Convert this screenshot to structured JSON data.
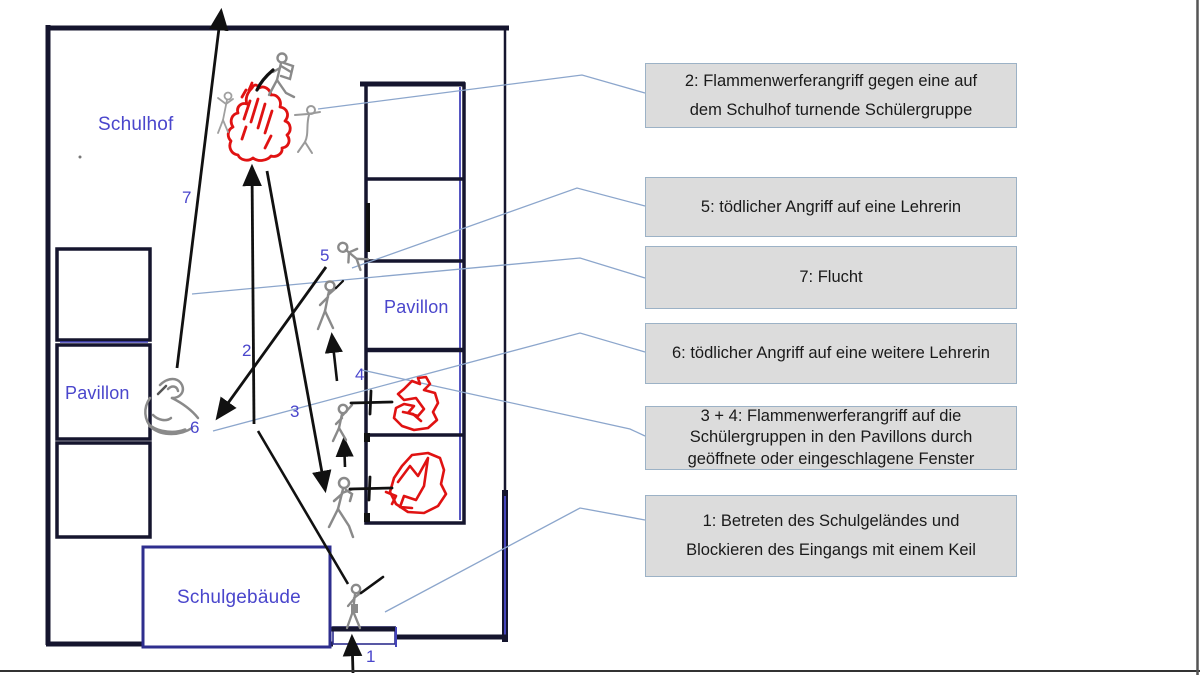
{
  "plan": {
    "area_labels": [
      {
        "id": "schulhof",
        "label": "Schulhof"
      },
      {
        "id": "pavillon-left",
        "label": "Pavillon"
      },
      {
        "id": "pavillon-right",
        "label": "Pavillon"
      },
      {
        "id": "schulgebaeude",
        "label": "Schulgebäude"
      }
    ],
    "step_markers": [
      {
        "n": "1"
      },
      {
        "n": "2"
      },
      {
        "n": "3"
      },
      {
        "n": "4"
      },
      {
        "n": "5"
      },
      {
        "n": "6"
      },
      {
        "n": "7"
      }
    ]
  },
  "callouts": [
    {
      "id": "callout-2",
      "text": "2: Flammenwerferangriff gegen eine auf\ndem Schulhof turnende Schülergruppe"
    },
    {
      "id": "callout-5",
      "text": "5: tödlicher Angriff auf eine Lehrerin"
    },
    {
      "id": "callout-7",
      "text": "7: Flucht"
    },
    {
      "id": "callout-6",
      "text": "6: tödlicher Angriff auf eine weitere Lehrerin"
    },
    {
      "id": "callout-3-4",
      "text": "3 + 4: Flammenwerferangriff auf die\nSchülergruppen in den Pavillons durch\ngeöffnete oder eingeschlagene Fenster"
    },
    {
      "id": "callout-1",
      "text": "1: Betreten des Schulgeländes und\nBlockieren des Eingangs mit einem Keil"
    }
  ],
  "colors": {
    "map_label": "#4a46cc",
    "callout_fill": "#dcdcdc",
    "callout_border": "#9cb2c6",
    "connector_line": "#8ca6cc",
    "fire_red": "#e01212",
    "figure_gray": "#8a8a8a",
    "wall_dark": "#15152e",
    "building_navy": "#2e2e8e"
  }
}
